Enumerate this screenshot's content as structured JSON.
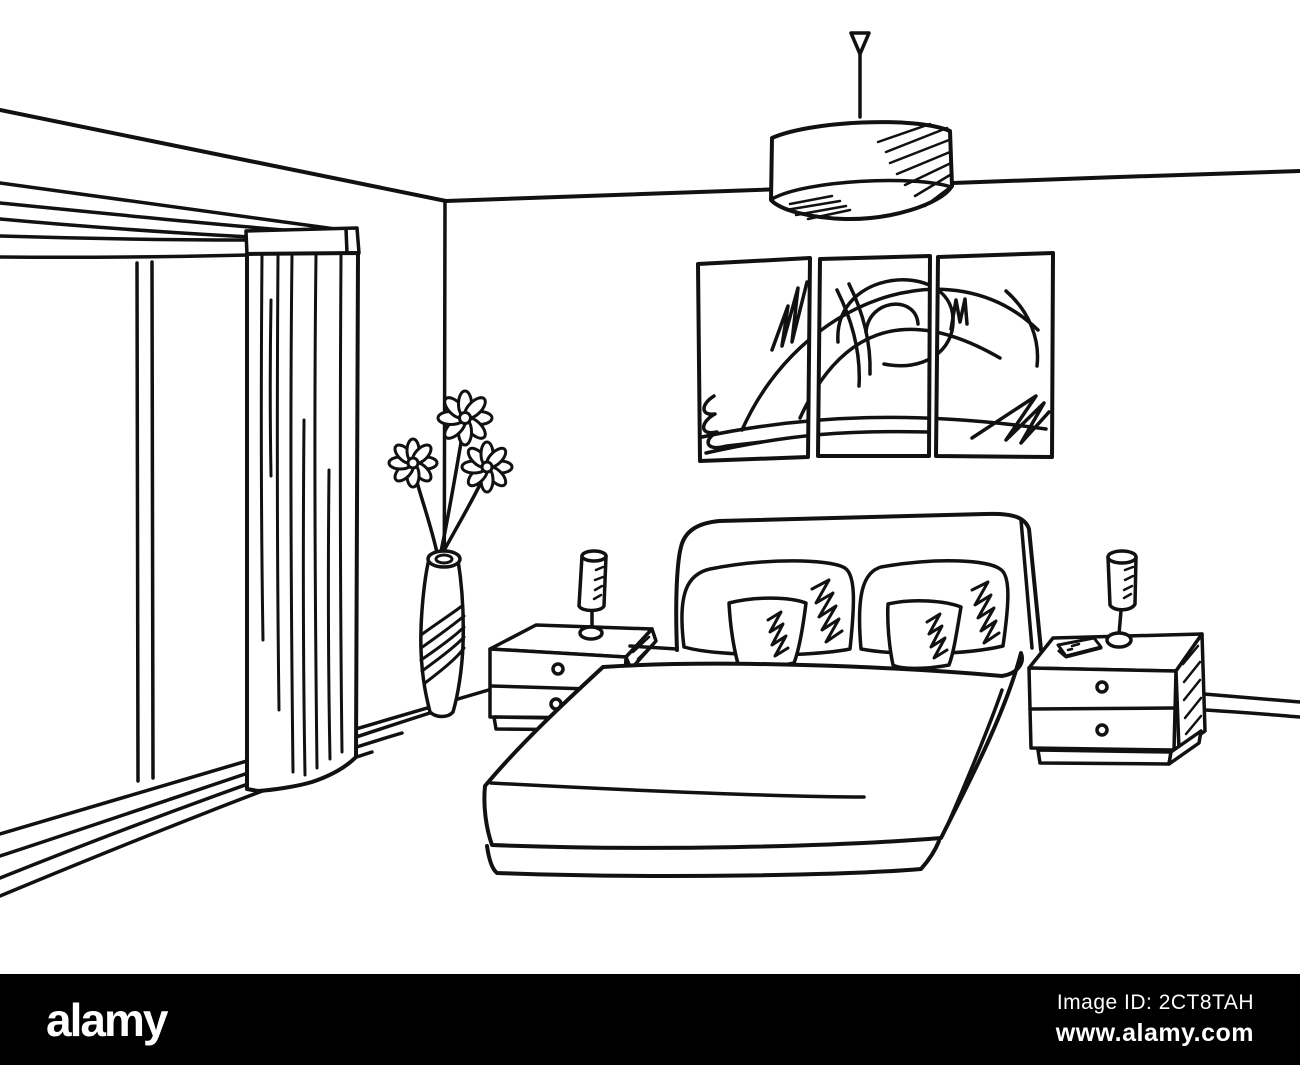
{
  "page": {
    "width": 1300,
    "height": 1065,
    "background": "#ffffff"
  },
  "illustration": {
    "style": "black and white line sketch",
    "ink_color": "#111111",
    "background_color": "#ffffff"
  },
  "scene": {
    "room": "bedroom interior sketch",
    "ceiling_lamp": "drum ceiling pendant lamp",
    "wall_art": "three-panel abstract wall art",
    "window": "sliding window with frame",
    "curtain": "floor-length curtain",
    "vase": "tall striped vase with three daisies",
    "bed": "double bed with headboard, four pillows and duvet",
    "nightstand_left": "left nightstand with two drawers",
    "nightstand_right": "right nightstand with two drawers",
    "lamp_left": "left bedside lamp",
    "lamp_right": "right bedside lamp",
    "phone": "phone on right nightstand"
  },
  "footer": {
    "background": "#000000",
    "text_color": "#ffffff",
    "logo_text": "alamy",
    "image_id": "Image ID: 2CT8TAH",
    "website": "www.alamy.com"
  }
}
